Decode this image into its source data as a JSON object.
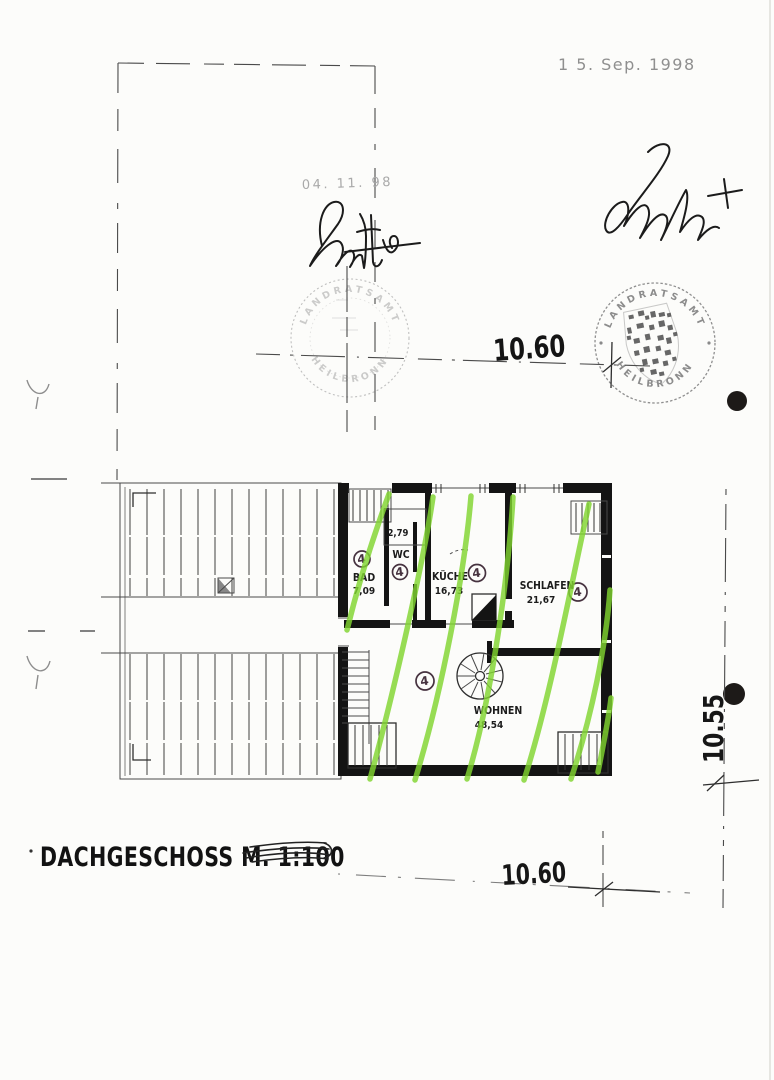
{
  "document": {
    "title": "DACHGESCHOSS M. 1:100"
  },
  "stamps": {
    "date_top": "1 5. Sep. 1998",
    "date_middle": "04. 11. 98",
    "seal_left": {
      "arc_top": "LANDRATSAMT",
      "arc_bottom": "HEILBRONN"
    },
    "seal_right": {
      "arc_top": "LANDRATSAMT",
      "arc_bottom": "HEILBRONN"
    }
  },
  "dimensions": {
    "top_width": "10.60",
    "bottom_width": "10.60",
    "right_height": "10.55"
  },
  "plan": {
    "rooms": [
      {
        "name": "BAD",
        "area": "7,09",
        "badge": "4"
      },
      {
        "name": "WC",
        "area": "2,79",
        "badge": "4"
      },
      {
        "name": "KÜCHE",
        "area": "16,73",
        "badge": "4"
      },
      {
        "name": "SCHLAFEN",
        "area": "21,67",
        "badge": "4"
      },
      {
        "name": "WOHNEN",
        "area": "48,54",
        "badge": "4"
      }
    ]
  },
  "colors": {
    "highlight_green": "#80d430",
    "ink": "#1a1a1a",
    "stamp_gray": "#8f8f8f"
  }
}
